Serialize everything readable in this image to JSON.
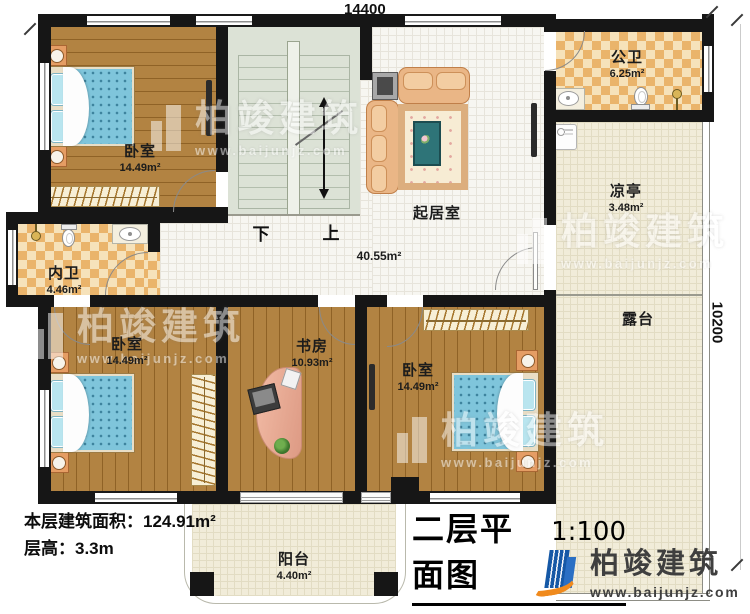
{
  "dimensions": {
    "width_mm": "14400",
    "height_mm": "10200"
  },
  "rooms": {
    "bedroom_tl": {
      "name": "卧室",
      "area": "14.49m²"
    },
    "bedroom_bl": {
      "name": "卧室",
      "area": "14.49m²"
    },
    "bedroom_br": {
      "name": "卧室",
      "area": "14.49m²"
    },
    "study": {
      "name": "书房",
      "area": "10.93m²"
    },
    "living": {
      "name": "起居室",
      "area": "40.55m²"
    },
    "public_bath": {
      "name": "公卫",
      "area": "6.25m²"
    },
    "inner_bath": {
      "name": "内卫",
      "area": "4.46m²"
    },
    "pavilion": {
      "name": "凉亭",
      "area": "3.48m²"
    },
    "terrace": {
      "name": "露台"
    },
    "balcony": {
      "name": "阳台",
      "area": "4.40m²"
    }
  },
  "stairs": {
    "down_label": "下",
    "up_label": "上"
  },
  "info": {
    "floor_area": "本层建筑面积：124.91m²",
    "floor_height": "层高：3.3m"
  },
  "title_block": {
    "title": "二层平面图",
    "scale": "1:100"
  },
  "branding": {
    "company": "柏竣建筑",
    "website": "www.baijunjz.com"
  },
  "colors": {
    "wall": "#161616",
    "wood": "#ab7a36",
    "living_floor": "#f7f6f1",
    "bath_checker": "#eab46b",
    "outdoor_floor": "#f1ecd9",
    "stair_floor": "#dce2d6",
    "bed_blue": "#7fc5db",
    "sofa_tan": "#eab686",
    "logo_blue": "#1558a6",
    "logo_orange": "#f08a1d"
  }
}
